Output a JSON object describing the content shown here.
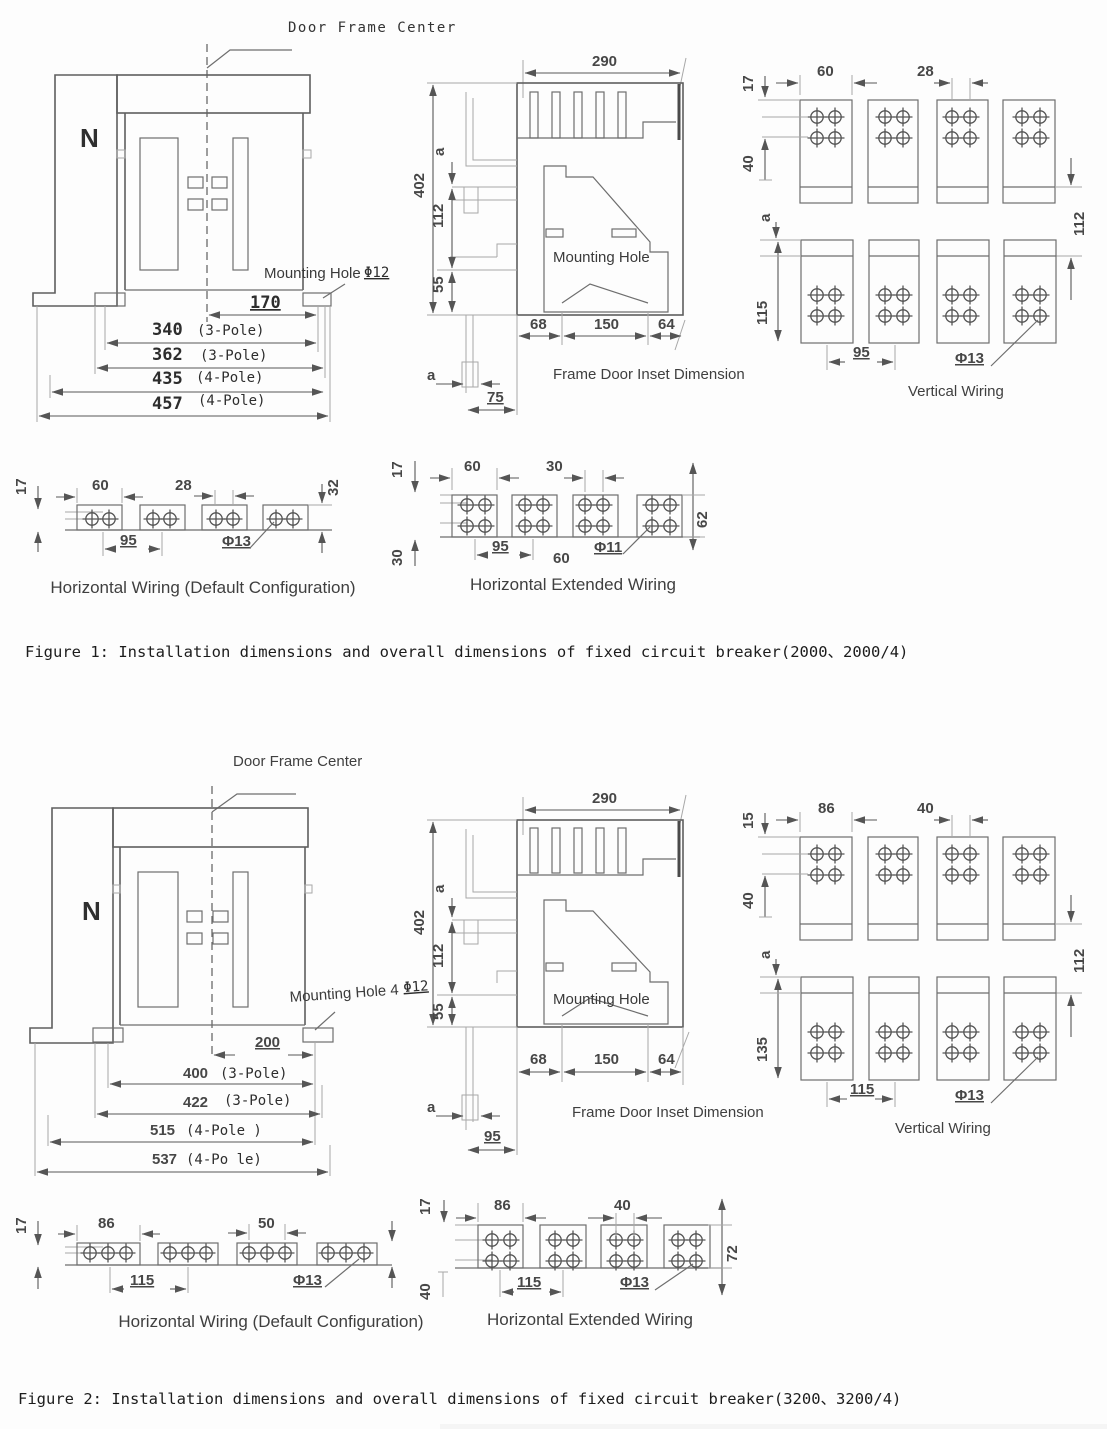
{
  "app": {
    "background": "#fdfdfd",
    "line_color": "#6e6e6e",
    "text_color": "#3a3a3a"
  },
  "fig1": {
    "front": {
      "door_frame_center": "Door Frame Center",
      "neutral": "N",
      "mounting_hole": "Mounting Hole",
      "hole_size": "Φ12",
      "d170": "170",
      "d340": "340",
      "d340_note": "(3-Pole)",
      "d362": "362",
      "d362_note": "(3-Pole)",
      "d435": "435",
      "d435_note": "(4-Pole)",
      "d457": "457",
      "d457_note": "(4-Pole)"
    },
    "side": {
      "w290": "290",
      "h402": "402",
      "a_top": "a",
      "h112": "112",
      "h55": "55",
      "b68": "68",
      "b150": "150",
      "b64": "64",
      "a_bottom": "a",
      "b75": "75",
      "mounting_hole": "Mounting Hole",
      "title": "Frame Door Inset Dimension"
    },
    "vertical": {
      "d17": "17",
      "d60": "60",
      "d28": "28",
      "d40": "40",
      "a": "a",
      "d115": "115",
      "d112": "112",
      "d95": "95",
      "hole": "Φ13",
      "title": "Vertical Wiring"
    },
    "horizontal": {
      "d17": "17",
      "d60": "60",
      "d28": "28",
      "d32": "32",
      "d95": "95",
      "hole": "Φ13",
      "title": "Horizontal Wiring (Default Configuration)"
    },
    "extended": {
      "d17": "17",
      "d60": "60",
      "d30_top": "30",
      "d62": "62",
      "d30_bottom": "30",
      "d95": "95",
      "d60_bottom": "60",
      "hole": "Φ11",
      "title": "Horizontal Extended Wiring"
    },
    "caption": "Figure 1: Installation dimensions and overall dimensions of fixed circuit breaker(2000、2000/4)"
  },
  "fig2": {
    "front": {
      "door_frame_center": "Door Frame Center",
      "neutral": "N",
      "mounting_hole": "Mounting Hole 4",
      "hole_size": "Φ12",
      "d200": "200",
      "d400": "400",
      "d400_note": "(3-Pole)",
      "d422": "422",
      "d422_note": "(3-Pole)",
      "d515": "515",
      "d515_note": "(4-Pole )",
      "d537": "537",
      "d537_note": "(4-Po le)"
    },
    "side": {
      "w290": "290",
      "h402": "402",
      "a_top": "a",
      "h112": "112",
      "h55": "55",
      "b68": "68",
      "b150": "150",
      "b64": "64",
      "a_bottom": "a",
      "b95": "95",
      "mounting_hole": "Mounting Hole",
      "title": "Frame Door Inset Dimension"
    },
    "vertical": {
      "d15": "15",
      "d86": "86",
      "d40_top": "40",
      "d40": "40",
      "a": "a",
      "d135": "135",
      "d112": "112",
      "d115": "115",
      "hole": "Φ13",
      "title": "Vertical Wiring"
    },
    "horizontal": {
      "d17": "17",
      "d86": "86",
      "d50": "50",
      "d115": "115",
      "hole": "Φ13",
      "title": "Horizontal Wiring (Default Configuration)"
    },
    "extended": {
      "d17": "17",
      "d86": "86",
      "d40": "40",
      "d72": "72",
      "d40_bottom": "40",
      "d115": "115",
      "hole": "Φ13",
      "title": "Horizontal Extended Wiring"
    },
    "caption": "Figure 2: Installation dimensions and overall dimensions of fixed circuit breaker(3200、3200/4)"
  }
}
